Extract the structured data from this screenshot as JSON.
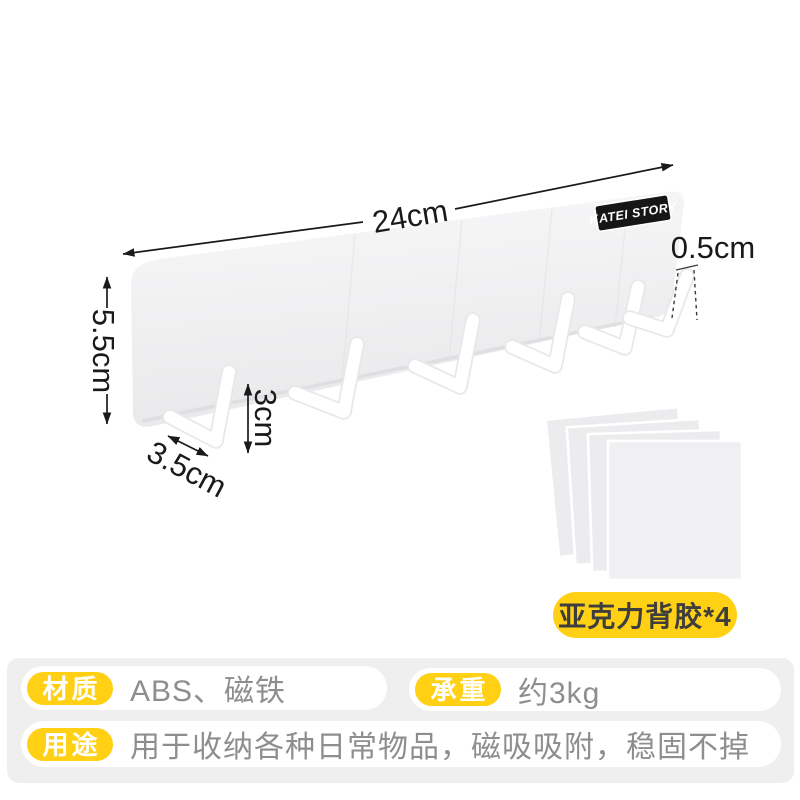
{
  "product": {
    "brand": "KATEI STORY",
    "dimensions": {
      "bar_width": "24cm",
      "bar_height": "5.5cm",
      "hook_depth": "3.5cm",
      "hook_height": "3cm",
      "hook_thickness": "0.5cm"
    },
    "adhesive_label": "亚克力背胶*4",
    "hook_count": 6
  },
  "specs": {
    "material": {
      "label": "材质",
      "value": "ABS、磁铁"
    },
    "load": {
      "label": "承重",
      "value": "约3kg"
    },
    "usage": {
      "label": "用途",
      "value": "用于收纳各种日常物品，磁吸吸附，稳固不掉"
    }
  },
  "colors": {
    "accent_yellow": "#ffd013",
    "panel_gray": "#efeff0",
    "text_gray": "#8e8e8e",
    "ink": "#1a1a1a",
    "bar_fill_top": "#f8f8f9",
    "bar_fill_bottom": "#e9e9eb",
    "badge_bg": "#161616",
    "hook_white": "#ffffff"
  }
}
